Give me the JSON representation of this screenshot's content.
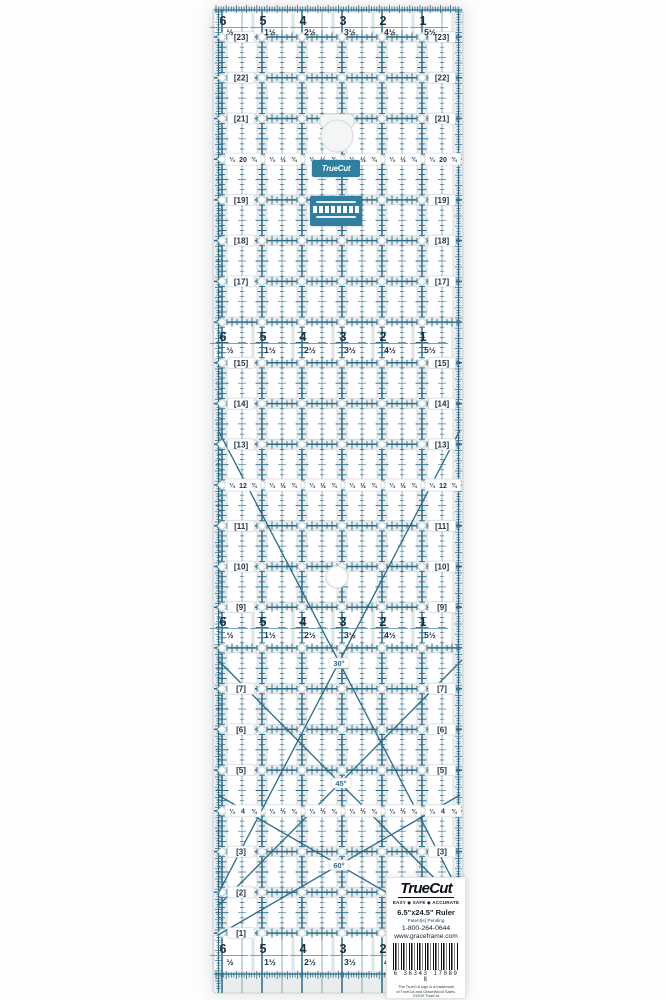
{
  "product": {
    "brand": "TrueCut",
    "tagline": "EASY ◆ SAFE ◆ ACCURATE",
    "size_label": "6.5\"x24.5\" Ruler",
    "patent": "Patent(s) Pending",
    "phone": "1-800-264-0644",
    "website": "www.graceframe.com",
    "barcode_number": "6 36343 17089 8",
    "trademark_line1": "The TrueCut logo is a trademark",
    "trademark_line2": "of TrueCut and GraceWood Sales.",
    "copyright": "©2010 TrueCut",
    "made_in": "MADE IN CHINA"
  },
  "mini_labels": {
    "brand": "TrueCut"
  },
  "colors": {
    "teal": "#2a6b88",
    "teal_light": "#4d86a0",
    "navy": "#1d2f41",
    "body": "#e9edee",
    "cell_fill": "#ffffff",
    "cell_stroke": "#d3d9db",
    "diamond_stroke": "#bcc9cf",
    "edge_stroke": "#cbd2d5",
    "angle_text": "#2a6b88"
  },
  "ruler": {
    "columns_whole": [
      "6",
      "5",
      "4",
      "3",
      "2",
      "1"
    ],
    "columns_half": [
      "½",
      "1½",
      "2½",
      "3½",
      "4½",
      "5½"
    ],
    "fraction_tokens": [
      "¼",
      "½",
      "¾"
    ],
    "rows": [
      {
        "label": "23",
        "type": "plain"
      },
      {
        "label": "22",
        "type": "plain"
      },
      {
        "label": "21",
        "type": "plain"
      },
      {
        "label": "20",
        "type": "fraction"
      },
      {
        "label": "19",
        "type": "plain"
      },
      {
        "label": "18",
        "type": "plain"
      },
      {
        "label": "17",
        "type": "plain"
      },
      {
        "label": "16",
        "type": "band"
      },
      {
        "label": "15",
        "type": "plain"
      },
      {
        "label": "14",
        "type": "plain"
      },
      {
        "label": "13",
        "type": "plain"
      },
      {
        "label": "12",
        "type": "fraction"
      },
      {
        "label": "11",
        "type": "plain"
      },
      {
        "label": "10",
        "type": "plain"
      },
      {
        "label": "9",
        "type": "plain"
      },
      {
        "label": "8",
        "type": "band"
      },
      {
        "label": "7",
        "type": "plain"
      },
      {
        "label": "6",
        "type": "plain"
      },
      {
        "label": "5",
        "type": "plain"
      },
      {
        "label": "4",
        "type": "fraction"
      },
      {
        "label": "3",
        "type": "plain"
      },
      {
        "label": "2",
        "type": "plain"
      },
      {
        "label": "1",
        "type": "plain"
      }
    ],
    "angle_labels": [
      {
        "text": "30°",
        "x": 339,
        "y": 663
      },
      {
        "text": "45°",
        "x": 341,
        "y": 783
      },
      {
        "text": "60°",
        "x": 339,
        "y": 865
      }
    ]
  }
}
